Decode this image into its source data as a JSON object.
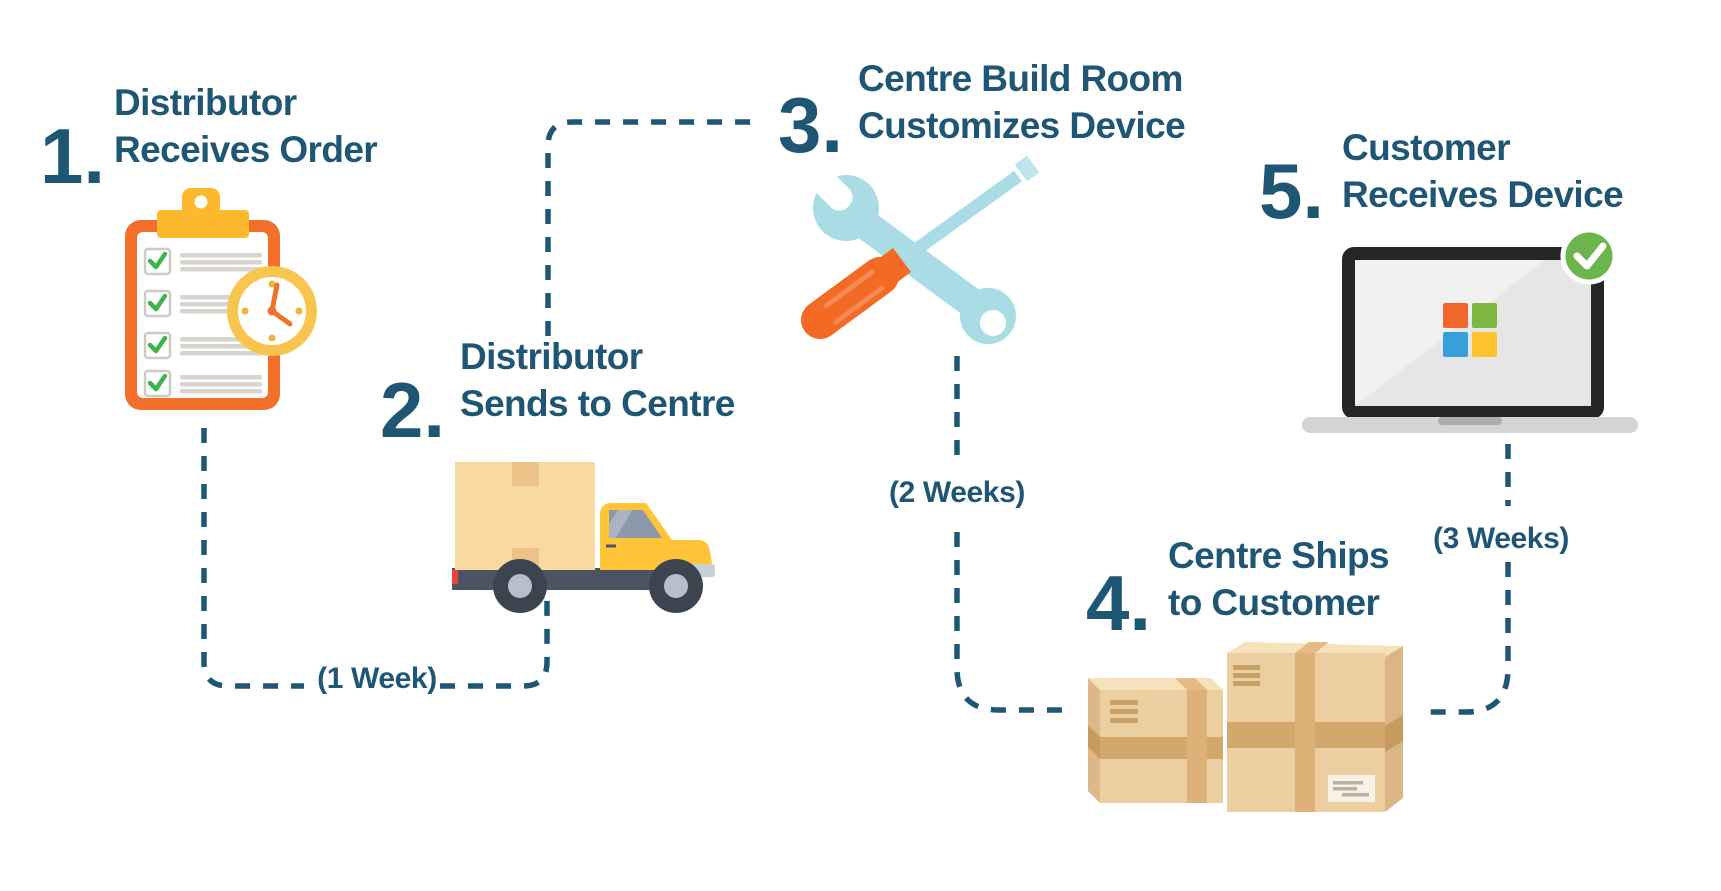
{
  "diagram_title": "Device order and delivery process",
  "palette": {
    "text_dark_blue": "#1e5674",
    "connector_dash": "#1e5674",
    "orange": "#f3702b",
    "yellow": "#fdb92d",
    "green_check": "#3cb54a",
    "badge_green": "#6cb44c",
    "teal_tool": "#a9dce4",
    "cardboard": "#eccfa0",
    "truck_yellow": "#ffc438",
    "ms_orange": "#f1662a",
    "ms_green": "#7eb843",
    "ms_blue": "#379fd9",
    "ms_yellow": "#fdc22e"
  },
  "steps": [
    {
      "number": "1.",
      "line1": "Distributor",
      "line2": "Receives Order",
      "icon": "clipboard-with-clock"
    },
    {
      "number": "2.",
      "line1": "Distributor",
      "line2": "Sends to Centre",
      "icon": "delivery-truck"
    },
    {
      "number": "3.",
      "line1": "Centre Build Room",
      "line2": "Customizes Device",
      "icon": "wrench-and-screwdriver"
    },
    {
      "number": "4.",
      "line1": "Centre Ships",
      "line2": "to Customer",
      "icon": "shipping-boxes"
    },
    {
      "number": "5.",
      "line1": "Customer",
      "line2": "Receives Device",
      "icon": "laptop-with-check"
    }
  ],
  "durations": [
    {
      "label": "(1 Week)",
      "between": "step 1 and step 2"
    },
    {
      "label": "(2 Weeks)",
      "between": "step 3 and step 4"
    },
    {
      "label": "(3 Weeks)",
      "between": "step 5 and step 4"
    }
  ]
}
